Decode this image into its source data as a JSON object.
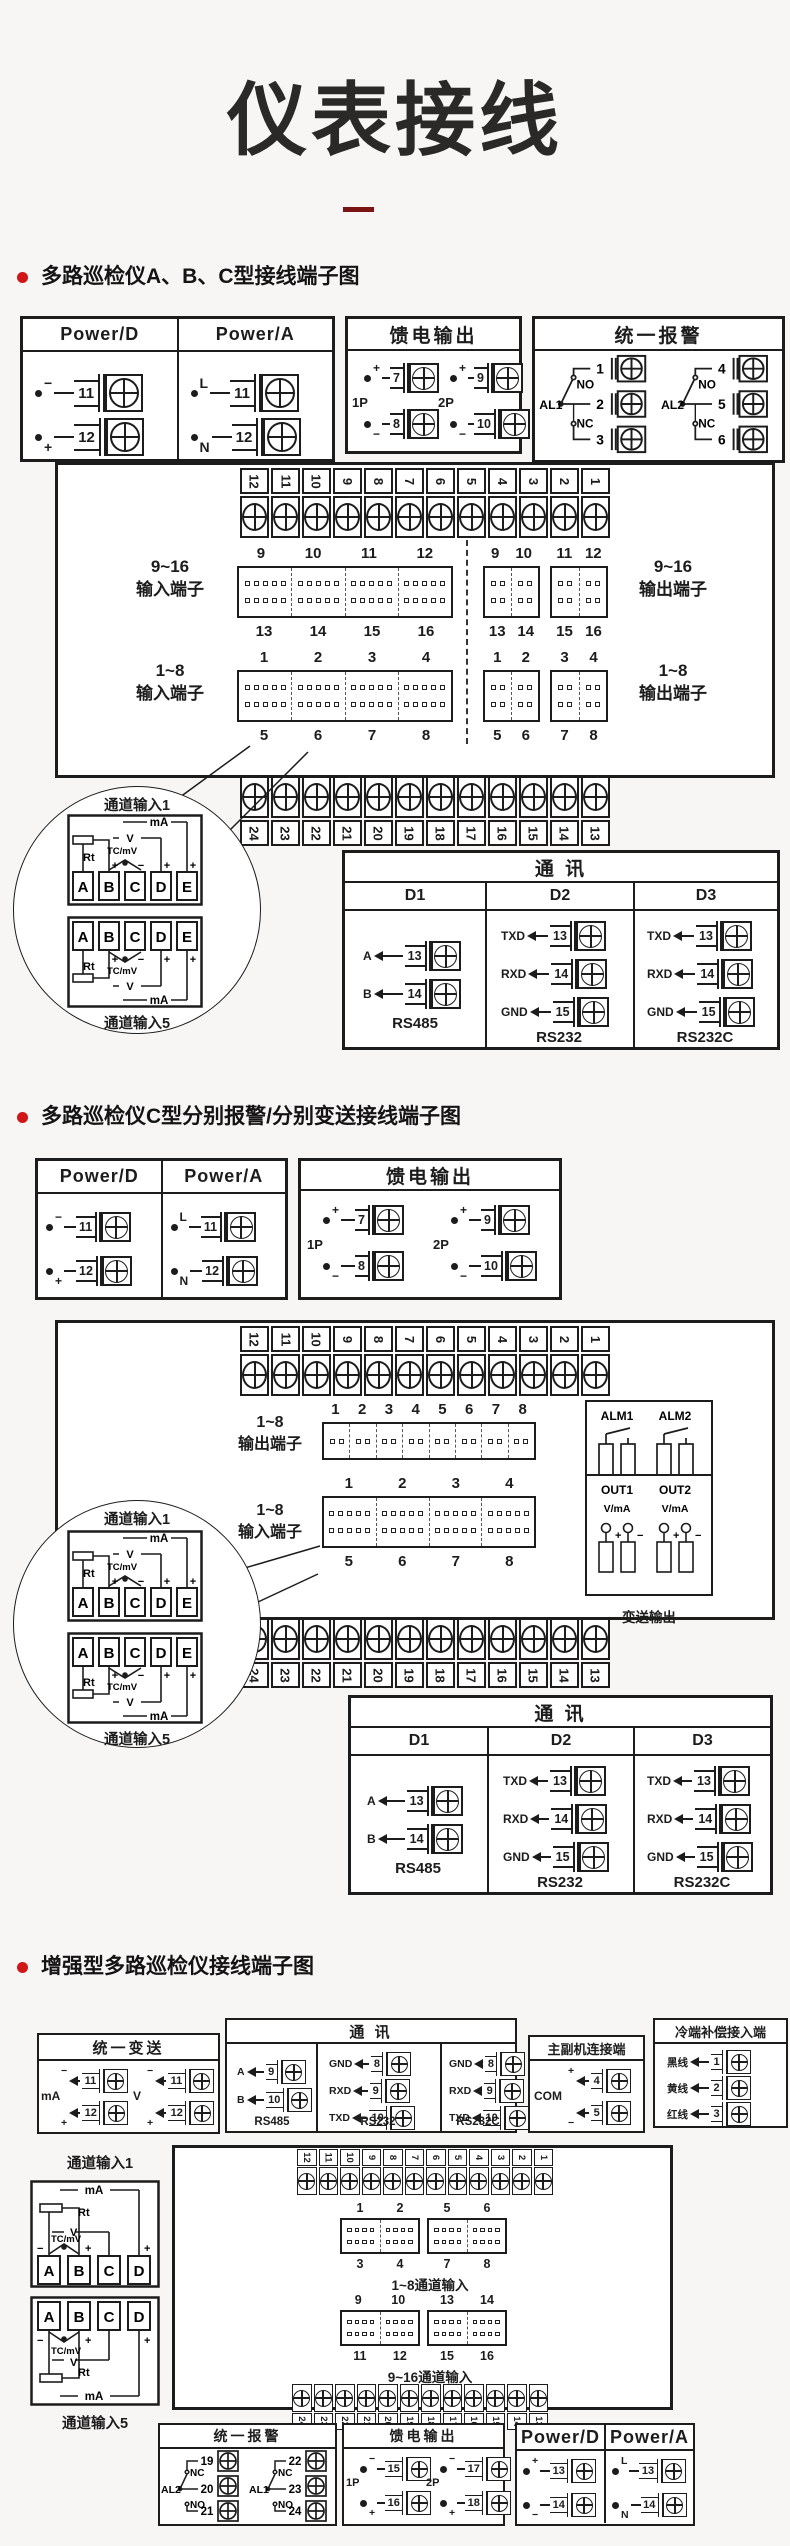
{
  "page": {
    "title": "仪表接线"
  },
  "s1": {
    "heading": "多路巡检仪A、B、C型接线端子图",
    "power": {
      "d_title": "Power/D",
      "a_title": "Power/A",
      "d1_sig": "−",
      "d1_num": "11",
      "d2_sig": "+",
      "d2_num": "12",
      "a1_sig": "L",
      "a1_num": "11",
      "a2_sig": "N",
      "a2_num": "12"
    },
    "feed": {
      "title": "馈电输出",
      "g1": "1P",
      "g1_t_sig": "+",
      "g1_t_num": "7",
      "g1_b_sig": "−",
      "g1_b_num": "8",
      "g2": "2P",
      "g2_t_sig": "+",
      "g2_t_num": "9",
      "g2_b_sig": "−",
      "g2_b_num": "10"
    },
    "alarm": {
      "title": "统一报警",
      "r1": "AL1",
      "r1_no": "NO",
      "r1_nc": "NC",
      "r1_t1": "1",
      "r1_t2": "2",
      "r1_t3": "3",
      "r2": "AL2",
      "r2_no": "NO",
      "r2_nc": "NC",
      "r2_t1": "4",
      "r2_t2": "5",
      "r2_t3": "6"
    },
    "top_strip": [
      "12",
      "11",
      "10",
      "9",
      "8",
      "7",
      "6",
      "5",
      "4",
      "3",
      "2",
      "1"
    ],
    "bottom_strip": [
      "24",
      "23",
      "22",
      "21",
      "20",
      "19",
      "18",
      "17",
      "16",
      "15",
      "14",
      "13"
    ],
    "in916_l1": "9~16",
    "in916_l2": "输入端子",
    "in916_top": [
      "9",
      "10",
      "11",
      "12"
    ],
    "in916_bot": [
      "13",
      "14",
      "15",
      "16"
    ],
    "out916_l1": "9~16",
    "out916_l2": "输出端子",
    "out916_t1": [
      "9",
      "10"
    ],
    "out916_t2": [
      "11",
      "12"
    ],
    "out916_b1": [
      "13",
      "14"
    ],
    "out916_b2": [
      "15",
      "16"
    ],
    "in18_l1": "1~8",
    "in18_l2": "输入端子",
    "in18_top": [
      "1",
      "2",
      "3",
      "4"
    ],
    "in18_bot": [
      "5",
      "6",
      "7",
      "8"
    ],
    "out18_l1": "1~8",
    "out18_l2": "输出端子",
    "out18_t1": [
      "1",
      "2"
    ],
    "out18_t2": [
      "3",
      "4"
    ],
    "out18_b1": [
      "5",
      "6"
    ],
    "out18_b2": [
      "7",
      "8"
    ],
    "ch": {
      "label1": "通道输入1",
      "label5": "通道输入5",
      "t0": "A",
      "t1": "B",
      "t2": "C",
      "t3": "D",
      "t4": "E",
      "rt": "Rt",
      "tc": "TC/mV",
      "v": "V",
      "ma": "mA",
      "plus": "+",
      "minus": "−"
    },
    "comm": {
      "title": "通  讯",
      "d1": "D1",
      "d2": "D2",
      "d3": "D3",
      "c1r1_sig": "A",
      "c1r1_num": "13",
      "c1r2_sig": "B",
      "c1r2_num": "14",
      "c1_proto": "RS485",
      "c2r1_sig": "TXD",
      "c2r1_num": "13",
      "c2r2_sig": "RXD",
      "c2r2_num": "14",
      "c2r3_sig": "GND",
      "c2r3_num": "15",
      "c2_proto": "RS232",
      "c3r1_sig": "TXD",
      "c3r1_num": "13",
      "c3r2_sig": "RXD",
      "c3r2_num": "14",
      "c3r3_sig": "GND",
      "c3r3_num": "15",
      "c3_proto": "RS232C"
    }
  },
  "s2": {
    "heading": "多路巡检仪C型分别报警/分别变送接线端子图",
    "power": {
      "d_title": "Power/D",
      "a_title": "Power/A",
      "d1_sig": "−",
      "d1_num": "11",
      "d2_sig": "+",
      "d2_num": "12",
      "a1_sig": "L",
      "a1_num": "11",
      "a2_sig": "N",
      "a2_num": "12"
    },
    "feed": {
      "title": "馈电输出",
      "g1": "1P",
      "g1_t_sig": "+",
      "g1_t_num": "7",
      "g1_b_sig": "−",
      "g1_b_num": "8",
      "g2": "2P",
      "g2_t_sig": "+",
      "g2_t_num": "9",
      "g2_b_sig": "−",
      "g2_b_num": "10"
    },
    "top_strip": [
      "12",
      "11",
      "10",
      "9",
      "8",
      "7",
      "6",
      "5",
      "4",
      "3",
      "2",
      "1"
    ],
    "bottom_strip": [
      "24",
      "23",
      "22",
      "21",
      "20",
      "19",
      "18",
      "17",
      "16",
      "15",
      "14",
      "13"
    ],
    "out18_l1": "1~8",
    "out18_l2": "输出端子",
    "out18_nums": [
      "1",
      "2",
      "3",
      "4",
      "5",
      "6",
      "7",
      "8"
    ],
    "alarm_out": {
      "a1": "ALM1",
      "a2": "ALM2",
      "label": "报警输出"
    },
    "in18_l1": "1~8",
    "in18_l2": "输入端子",
    "in18_top": [
      "1",
      "2",
      "3",
      "4"
    ],
    "in18_bot": [
      "5",
      "6",
      "7",
      "8"
    ],
    "trans_out": {
      "o1": "OUT1",
      "o2": "OUT2",
      "u1": "V/mA",
      "u2": "V/mA",
      "p1": "+",
      "m1": "−",
      "p2": "+",
      "m2": "−",
      "label": "变送输出"
    },
    "ch": {
      "label1": "通道输入1",
      "label5": "通道输入5",
      "t0": "A",
      "t1": "B",
      "t2": "C",
      "t3": "D",
      "t4": "E",
      "rt": "Rt",
      "tc": "TC/mV",
      "v": "V",
      "ma": "mA",
      "plus": "+",
      "minus": "−"
    },
    "comm": {
      "title": "通  讯",
      "d1": "D1",
      "d2": "D2",
      "d3": "D3",
      "c1r1_sig": "A",
      "c1r1_num": "13",
      "c1r2_sig": "B",
      "c1r2_num": "14",
      "c1_proto": "RS485",
      "c2r1_sig": "TXD",
      "c2r1_num": "13",
      "c2r2_sig": "RXD",
      "c2r2_num": "14",
      "c2r3_sig": "GND",
      "c2r3_num": "15",
      "c2_proto": "RS232",
      "c3r1_sig": "TXD",
      "c3r1_num": "13",
      "c3r2_sig": "RXD",
      "c3r2_num": "14",
      "c3r3_sig": "GND",
      "c3r3_num": "15",
      "c3_proto": "RS232C"
    }
  },
  "s3": {
    "heading": "增强型多路巡检仪接线端子图",
    "trans": {
      "title": "统一变送",
      "g1": "mA",
      "g1_t_sig": "−",
      "g1_t_num": "11",
      "g1_b_sig": "+",
      "g1_b_num": "12",
      "g2": "V",
      "g2_t_sig": "−",
      "g2_t_num": "11",
      "g2_b_sig": "+",
      "g2_b_num": "12"
    },
    "comm": {
      "title": "通  讯",
      "c1r1_sig": "A",
      "c1r1_num": "9",
      "c1r2_sig": "B",
      "c1r2_num": "10",
      "c1_proto": "RS485",
      "c2r1_sig": "GND",
      "c2r1_num": "8",
      "c2r2_sig": "RXD",
      "c2r2_num": "9",
      "c2r3_sig": "TXD",
      "c2r3_num": "10",
      "c2_proto": "RS232",
      "c3r1_sig": "GND",
      "c3r1_num": "8",
      "c3r2_sig": "RXD",
      "c3r2_num": "9",
      "c3r3_sig": "TXD",
      "c3r3_num": "10",
      "c3_proto": "RS232C"
    },
    "link": {
      "title": "主副机连接端",
      "com": "COM",
      "r1_sig": "+",
      "r1_num": "4",
      "r2_sig": "−",
      "r2_num": "5"
    },
    "cold": {
      "title": "冷端补偿接入端",
      "r1_sig": "黑线",
      "r1_num": "1",
      "r2_sig": "黄线",
      "r2_num": "2",
      "r3_sig": "红线",
      "r3_num": "3"
    },
    "ch1_label": "通道输入1",
    "ch5_label": "通道输入5",
    "ch": {
      "t0": "A",
      "t1": "B",
      "t2": "C",
      "t3": "D",
      "rt": "Rt",
      "tc": "TC/mV",
      "v": "V",
      "ma": "mA",
      "plus": "+",
      "minus": "−"
    },
    "top_strip": [
      "12",
      "11",
      "10",
      "9",
      "8",
      "7",
      "6",
      "5",
      "4",
      "3",
      "2",
      "1"
    ],
    "bottom_strip": [
      "24",
      "23",
      "22",
      "21",
      "20",
      "19",
      "18",
      "17",
      "16",
      "15",
      "14",
      "13"
    ],
    "b18_t1": [
      "1",
      "2"
    ],
    "b18_t2": [
      "5",
      "6"
    ],
    "b18_b1": [
      "3",
      "4"
    ],
    "b18_b2": [
      "7",
      "8"
    ],
    "b18_label": "1~8通道输入",
    "b916_t1": [
      "9",
      "10"
    ],
    "b916_t2": [
      "13",
      "14"
    ],
    "b916_b1": [
      "11",
      "12"
    ],
    "b916_b2": [
      "15",
      "16"
    ],
    "b916_label": "9~16通道输入",
    "alarm": {
      "title": "统一报警",
      "r1": "AL2",
      "r1_nc": "NC",
      "r1_no": "NO",
      "r1_t1": "19",
      "r1_t2": "20",
      "r1_t3": "21",
      "r2": "AL1",
      "r2_nc": "NC",
      "r2_no": "NO",
      "r2_t1": "22",
      "r2_t2": "23",
      "r2_t3": "24"
    },
    "feed": {
      "title": "馈电输出",
      "g1": "1P",
      "g1_t_sig": "−",
      "g1_t_num": "15",
      "g1_b_sig": "+",
      "g1_b_num": "16",
      "g2": "2P",
      "g2_t_sig": "−",
      "g2_t_num": "17",
      "g2_b_sig": "+",
      "g2_b_num": "18"
    },
    "power": {
      "d_title": "Power/D",
      "a_title": "Power/A",
      "d1_sig": "+",
      "d1_num": "13",
      "d2_sig": "−",
      "d2_num": "14",
      "a1_sig": "L",
      "a1_num": "13",
      "a2_sig": "N",
      "a2_num": "14"
    }
  }
}
